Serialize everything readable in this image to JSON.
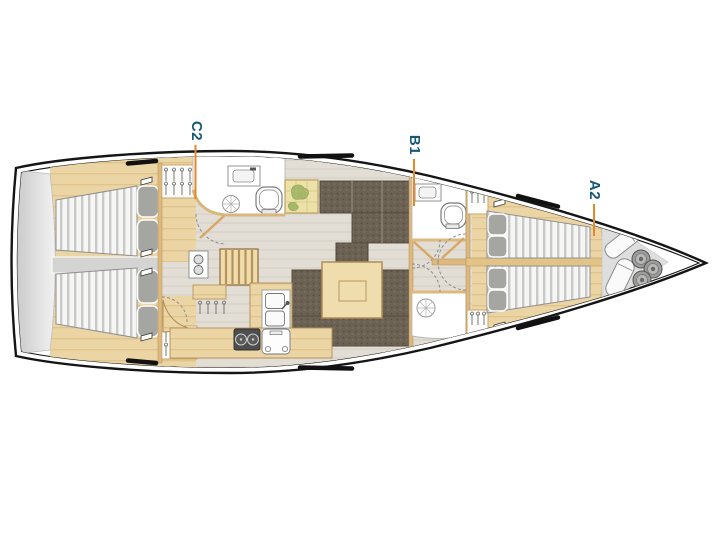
{
  "figure": {
    "kind": "yacht-interior-floor-plan",
    "orientation": "bow-right"
  },
  "labels": [
    {
      "text": "C2"
    },
    {
      "text": "B1"
    },
    {
      "text": "A2"
    }
  ],
  "colors": {
    "label_text": "#175877",
    "leader_line": "#E08A2C",
    "hull_outline": "#151515",
    "wood_trim": "#ECD5A4",
    "dark_upholstery": "#6B6254",
    "salon_floor": "#E2DED5",
    "mattress": "#F6F6F5",
    "pillow": "#A5A5A1",
    "transom_gray": "#D9D9D9",
    "forepeak_gray": "#DEDEDE",
    "chart_map": "#ECE2A8"
  }
}
